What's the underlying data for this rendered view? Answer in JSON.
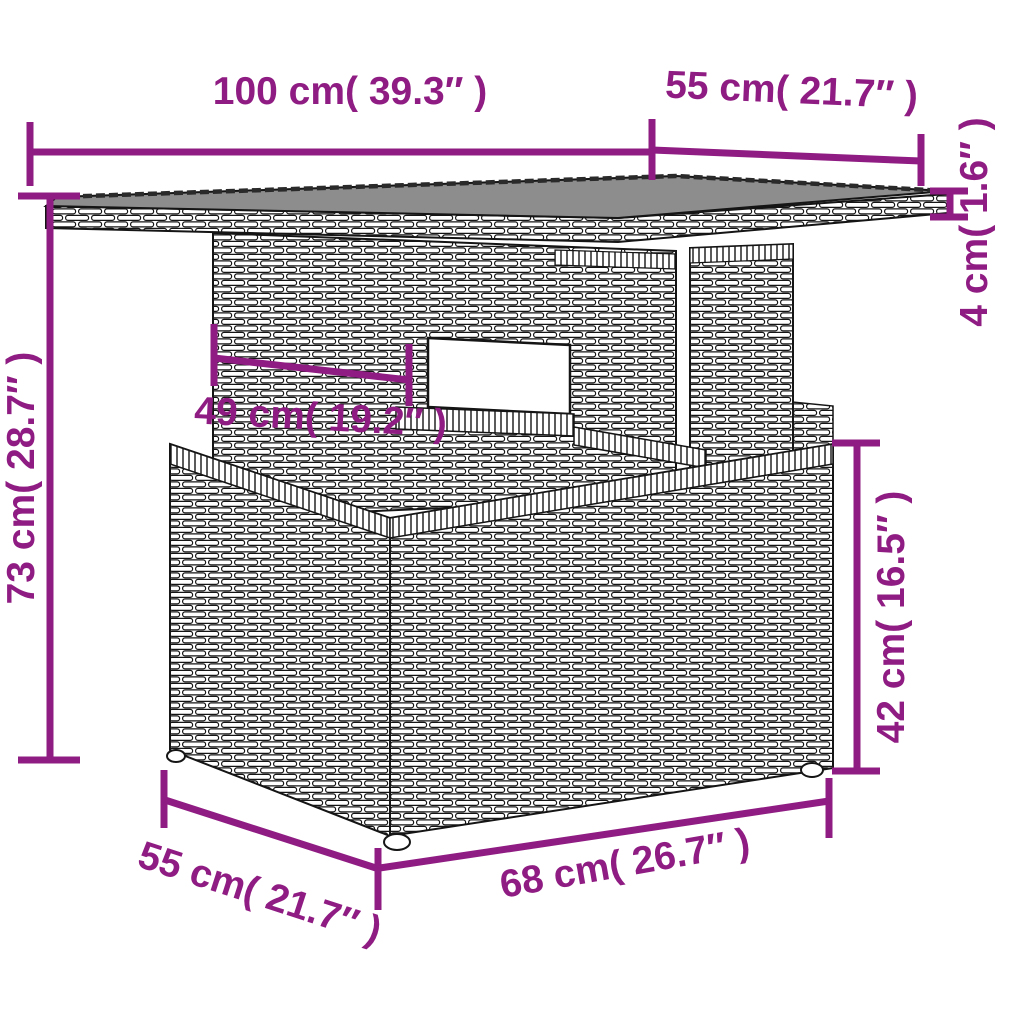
{
  "figure": {
    "type": "product-dimension-diagram",
    "subject": "poly rattan garden table line drawing",
    "accent_color": "#8F1C82",
    "line_art_color": "#151515",
    "tabletop_color": "#8d8d8d",
    "background_color": "#ffffff"
  },
  "dimensions": {
    "top_width": "100 cm( 39.3″ )",
    "top_depth": "55 cm( 21.7″ )",
    "top_thickness": "4 cm( 1.6″ )",
    "total_height": "73 cm( 28.7″ )",
    "pedestal_width": "49 cm( 19.2″ )",
    "base_height": "42 cm( 16.5″ )",
    "base_depth": "55 cm( 21.7″ )",
    "base_width": "68 cm( 26.7″ )"
  }
}
